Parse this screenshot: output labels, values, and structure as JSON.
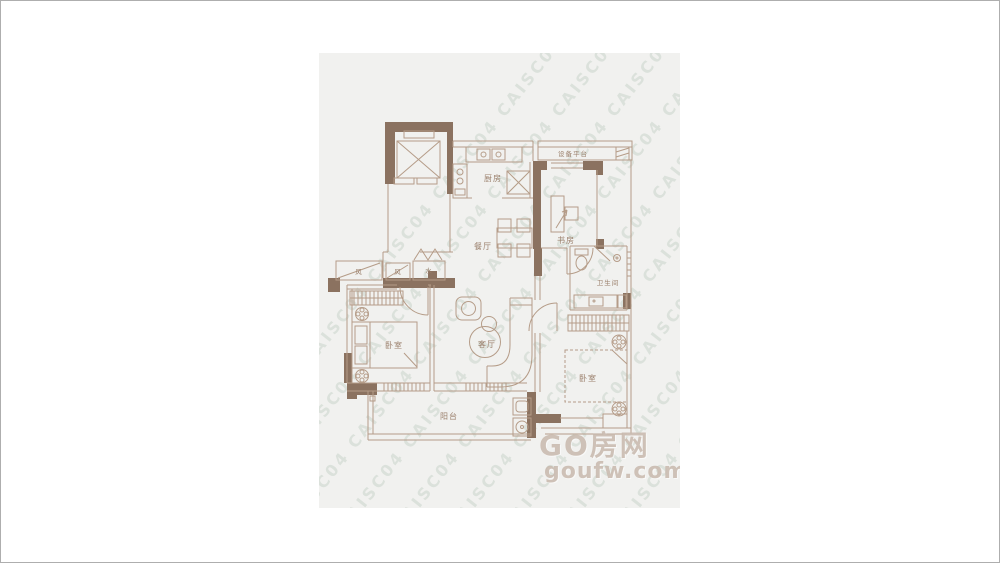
{
  "watermark": {
    "stripe": "CAISC04 CAISC04 CAISC04 CAISC04 CAISC04 CAISC04 CAISC04 CAISC04 CAISC04 CAISC04"
  },
  "logo": {
    "title": "GO房网",
    "domain": "goufw.com"
  },
  "rooms": {
    "kitchen": "厨房",
    "equipment_platform": "设备平台",
    "study": "书房",
    "dining": "餐厅",
    "bathroom": "卫生间",
    "living": "客厅",
    "bedroom_left": "卧室",
    "bedroom_right": "卧室",
    "balcony": "阳台",
    "riser_wind_1": "风",
    "riser_wind_2": "风",
    "riser_water": "水"
  },
  "colors": {
    "panel_background": "#f1f1ef",
    "wall": "#8b7260",
    "line": "#b59c88",
    "label": "#9a7f6b",
    "watermark": "#aabcac",
    "logo": "#c7b7ab"
  }
}
